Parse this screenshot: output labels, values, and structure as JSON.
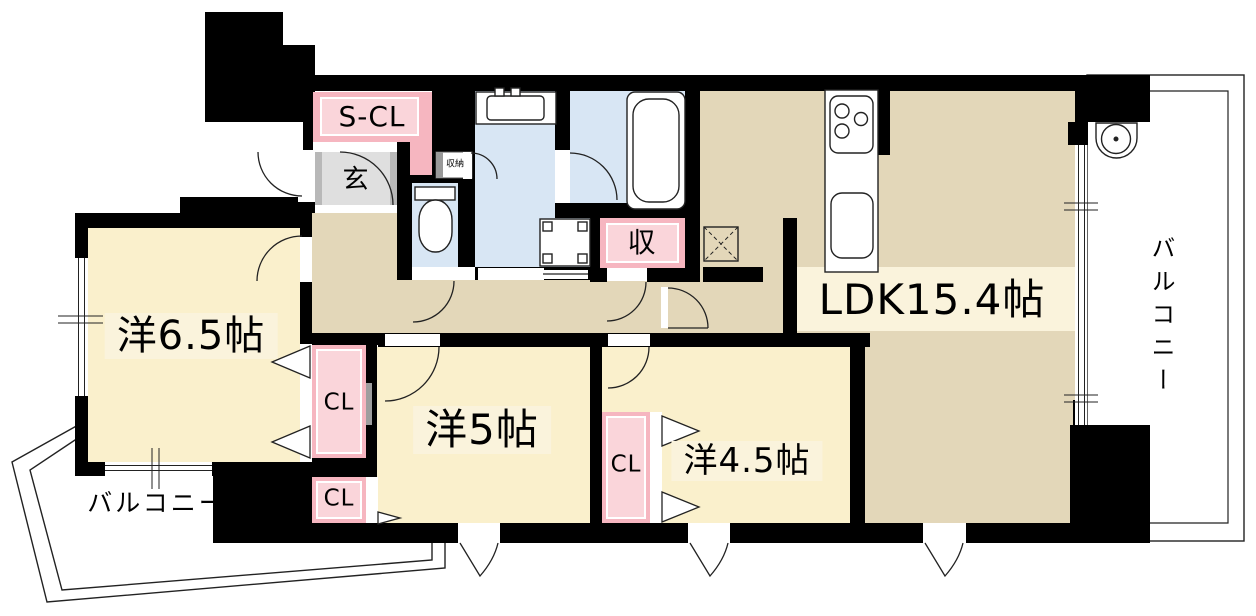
{
  "plan": {
    "type": "floorplan",
    "rooms": {
      "ldk": {
        "label": "LDK15.4帖"
      },
      "west1": {
        "label": "洋6.5帖"
      },
      "west2": {
        "label": "洋5帖"
      },
      "west3": {
        "label": "洋4.5帖"
      }
    },
    "storages": {
      "s_cl": {
        "label": "S-CL"
      },
      "cl_west1": {
        "label": "CL"
      },
      "cl_west2": {
        "label": "CL"
      },
      "cl_east": {
        "label": "CL"
      },
      "shu": {
        "label": "収"
      },
      "shunou": {
        "label": "収納"
      }
    },
    "entrance": {
      "label": "玄"
    },
    "balcony_left": {
      "label": "バルコニー"
    },
    "balcony_right": {
      "label": "バルコニー"
    },
    "colors": {
      "wall": "#000000",
      "room_floor": "#FAF0CC",
      "ldk_floor": "#E3D7B9",
      "wet_area": "#D8E6F4",
      "closet_pink": "#F6B6C0",
      "closet_pink_light": "#FAD5DA",
      "entrance_gray": "#DFDFDF",
      "label_bg": "#FAF3DC",
      "balcony": "#FFFFFF"
    }
  }
}
